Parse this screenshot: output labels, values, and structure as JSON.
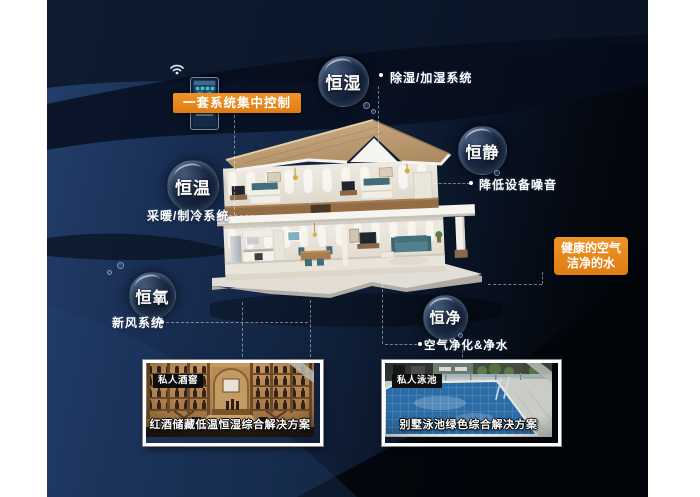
{
  "poster": {
    "control_panel_label": "一套系统集中控制",
    "highlight_box": {
      "line1": "健康的空气",
      "line2": "洁净的水"
    },
    "features": [
      {
        "name": "恒湿",
        "desc": "除湿/加湿系统"
      },
      {
        "name": "恒静",
        "desc": "降低设备噪音"
      },
      {
        "name": "恒温",
        "desc": "采暖/制冷系统"
      },
      {
        "name": "恒氧",
        "desc": "新风系统"
      },
      {
        "name": "恒净",
        "desc": "空气净化&净水"
      }
    ],
    "photo_cards": [
      {
        "tag": "私人酒窖",
        "caption": "红酒储藏低温恒湿综合解决方案"
      },
      {
        "tag": "私人泳池",
        "caption": "别墅泳池绿色综合解决方案"
      }
    ],
    "colors": {
      "accent_orange": "#E8861D",
      "background_navy": "#16294A",
      "bubble_text": "#FFFFFF"
    }
  }
}
